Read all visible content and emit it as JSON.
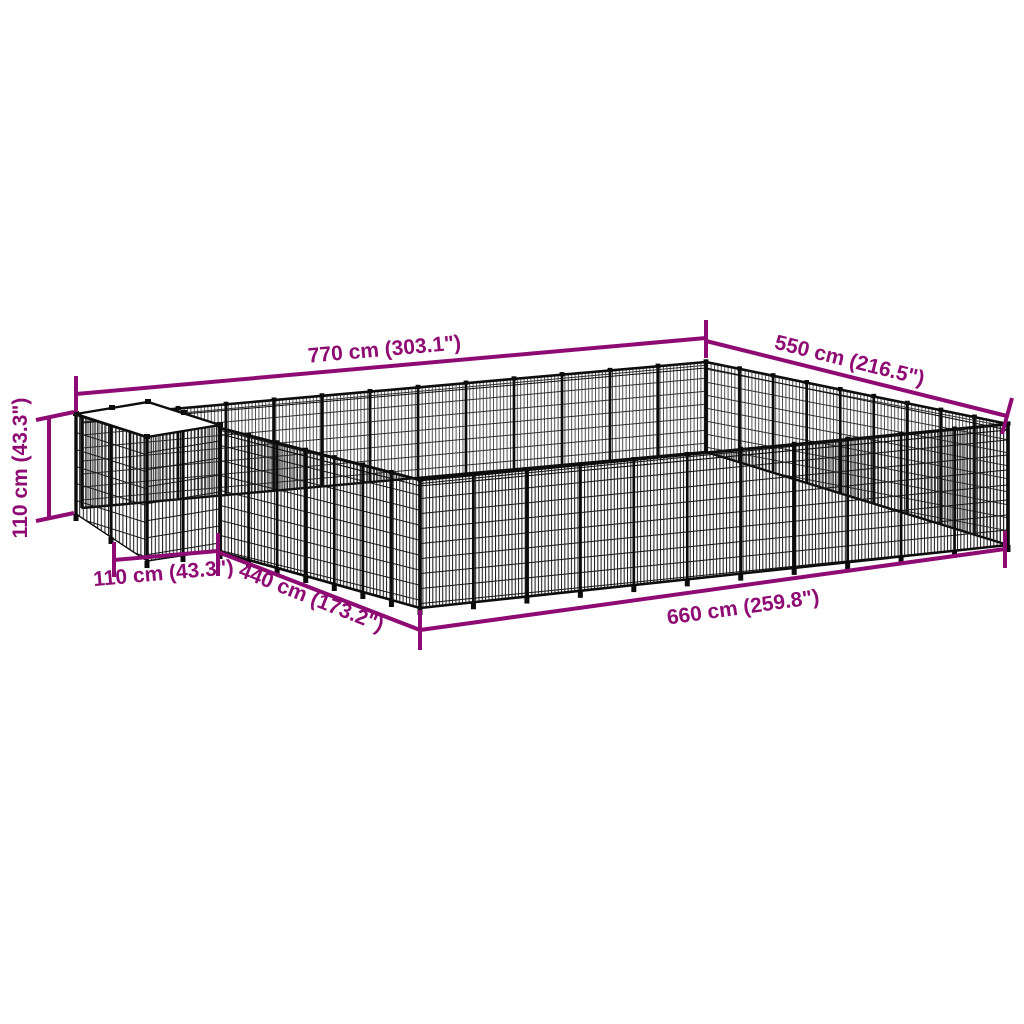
{
  "diagram": {
    "kind": "product-dimension-diagram",
    "colors": {
      "dimension_accent": "#8E0B73",
      "mesh_front": "#161616",
      "mesh_back": "#3f3f3f",
      "background": "#ffffff",
      "roof": "#ffffff"
    },
    "dimensions": {
      "back_left_width": {
        "label": "770 cm (303.1\")"
      },
      "back_right_depth": {
        "label": "550 cm (216.5\")"
      },
      "height": {
        "label": "110 cm (43.3\")"
      },
      "cube_front_width": {
        "label": "110 cm (43.3\")"
      },
      "front_left_depth": {
        "label": "440 cm (173.2\")"
      },
      "front_right_width": {
        "label": "660 cm (259.8\")"
      }
    }
  }
}
